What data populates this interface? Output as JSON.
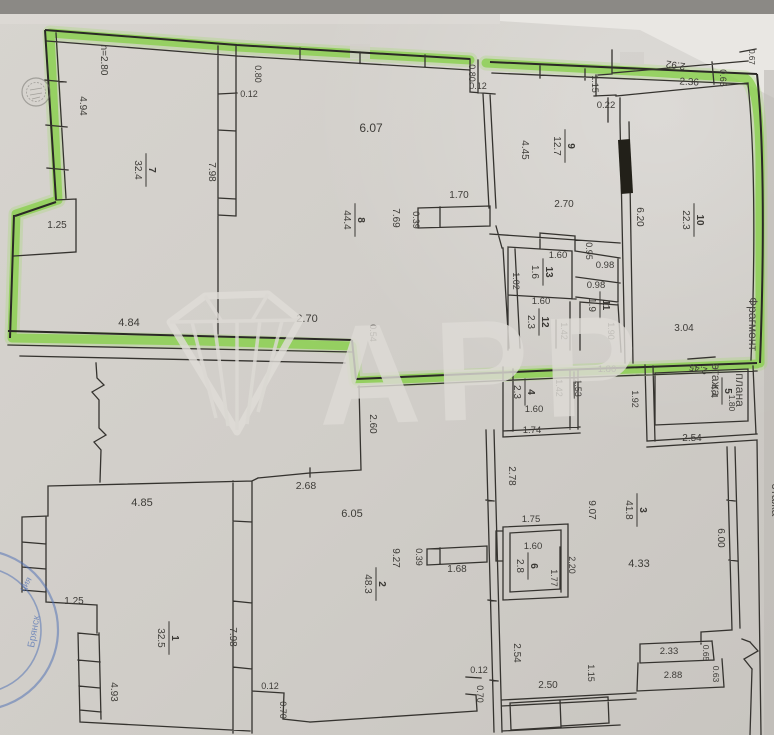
{
  "photo": {
    "description_visible_only": "scanned floor plan page with green highlighter outline",
    "colors": {
      "paper": "#d2cfca",
      "ink": "#35332f",
      "highlighter_green": "#7fce3c",
      "stamp_blue": "#4a6cb3",
      "watermark_gray": "#dedbd6",
      "photo_edge_dark": "#8b8985"
    }
  },
  "watermark": {
    "text": "АРР"
  },
  "stamps": {
    "blue": {
      "line1": "ция",
      "line2": "Брянск"
    }
  },
  "plan": {
    "captions": [
      {
        "t": "Фрагмент",
        "x": 749,
        "y": 324,
        "r": 90,
        "s": 12
      },
      {
        "t": "плана",
        "x": 736,
        "y": 390,
        "r": 90,
        "s": 12
      },
      {
        "t": "этажа",
        "x": 712,
        "y": 380,
        "r": 90,
        "s": 12
      },
      {
        "t": "этажа",
        "x": 772,
        "y": 500,
        "r": 90,
        "s": 12
      }
    ],
    "rooms": [
      {
        "n": "7",
        "a": "32.4",
        "x": 146,
        "y": 170
      },
      {
        "n": "8",
        "a": "44.4",
        "x": 355,
        "y": 220
      },
      {
        "n": "9",
        "a": "12.7",
        "x": 565,
        "y": 146
      },
      {
        "n": "10",
        "a": "22.3",
        "x": 694,
        "y": 220
      },
      {
        "n": "13",
        "a": "1.6",
        "x": 543,
        "y": 272
      },
      {
        "n": "12",
        "a": "2.3",
        "x": 539,
        "y": 322
      },
      {
        "n": "11",
        "a": "1.9",
        "x": 600,
        "y": 305
      },
      {
        "n": "4",
        "a": "2.3",
        "x": 525,
        "y": 392
      },
      {
        "n": "5",
        "a": "4.4",
        "x": 722,
        "y": 391
      },
      {
        "n": "1",
        "a": "32.5",
        "x": 169,
        "y": 638
      },
      {
        "n": "2",
        "a": "48.3",
        "x": 376,
        "y": 584
      },
      {
        "n": "3",
        "a": "41.8",
        "x": 637,
        "y": 510
      },
      {
        "n": "6",
        "a": "2.8",
        "x": 528,
        "y": 566
      }
    ],
    "dimensions": [
      {
        "t": "h=2.80",
        "x": 101,
        "y": 60,
        "r": 90,
        "s": 10
      },
      {
        "t": "4.94",
        "x": 80,
        "y": 106,
        "r": 90,
        "s": 10
      },
      {
        "t": "1.25",
        "x": 57,
        "y": 228,
        "r": 0,
        "s": 10
      },
      {
        "t": "7.98",
        "x": 209,
        "y": 172,
        "r": 90,
        "s": 10
      },
      {
        "t": "0.80",
        "x": 255,
        "y": 74,
        "r": 90,
        "s": 9
      },
      {
        "t": "0.12",
        "x": 249,
        "y": 97,
        "r": 0,
        "s": 9
      },
      {
        "t": "6.07",
        "x": 371,
        "y": 132,
        "r": 0,
        "s": 12
      },
      {
        "t": "7.69",
        "x": 393,
        "y": 218,
        "r": 90,
        "s": 10
      },
      {
        "t": "0.39",
        "x": 413,
        "y": 220,
        "r": 90,
        "s": 9
      },
      {
        "t": "1.70",
        "x": 459,
        "y": 198,
        "r": 0,
        "s": 10
      },
      {
        "t": "0.80",
        "x": 469,
        "y": 73,
        "r": 90,
        "s": 9
      },
      {
        "t": "0.12",
        "x": 478,
        "y": 89,
        "r": 0,
        "s": 9
      },
      {
        "t": "1.15",
        "x": 592,
        "y": 84,
        "r": 90,
        "s": 9
      },
      {
        "t": "0.22",
        "x": 606,
        "y": 108,
        "r": 0,
        "s": 9.5
      },
      {
        "t": "2.92",
        "x": 676,
        "y": 62,
        "r": 188,
        "s": 10
      },
      {
        "t": "2.36",
        "x": 689,
        "y": 85,
        "r": 4,
        "s": 10
      },
      {
        "t": "0.65",
        "x": 720,
        "y": 78,
        "r": 90,
        "s": 9
      },
      {
        "t": "0.67",
        "x": 749,
        "y": 57,
        "r": 90,
        "s": 8
      },
      {
        "t": "4.45",
        "x": 522,
        "y": 150,
        "r": 90,
        "s": 10
      },
      {
        "t": "2.70",
        "x": 564,
        "y": 207,
        "r": 0,
        "s": 10
      },
      {
        "t": "6.20",
        "x": 637,
        "y": 217,
        "r": 90,
        "s": 10
      },
      {
        "t": "3.04",
        "x": 684,
        "y": 331,
        "r": 0,
        "s": 10
      },
      {
        "t": "0.95",
        "x": 586,
        "y": 251,
        "r": 90,
        "s": 9
      },
      {
        "t": "0.98",
        "x": 605,
        "y": 268,
        "r": 0,
        "s": 9.5
      },
      {
        "t": "0.98",
        "x": 596,
        "y": 288,
        "r": 0,
        "s": 9.5
      },
      {
        "t": "1.60",
        "x": 558,
        "y": 258,
        "r": 0,
        "s": 9.5
      },
      {
        "t": "1.02",
        "x": 513,
        "y": 281,
        "r": 90,
        "s": 9
      },
      {
        "t": "1.60",
        "x": 541,
        "y": 304,
        "r": 0,
        "s": 9.5
      },
      {
        "t": "1.42",
        "x": 561,
        "y": 331,
        "r": 90,
        "s": 9
      },
      {
        "t": "1.90",
        "x": 608,
        "y": 331,
        "r": 90,
        "s": 9
      },
      {
        "t": "4.84",
        "x": 129,
        "y": 326,
        "r": 0,
        "s": 11
      },
      {
        "t": "2.70",
        "x": 307,
        "y": 322,
        "r": 0,
        "s": 11
      },
      {
        "t": "0.54",
        "x": 370,
        "y": 333,
        "r": 90,
        "s": 9
      },
      {
        "t": "2.60",
        "x": 370,
        "y": 424,
        "r": 90,
        "s": 10
      },
      {
        "t": "1.80",
        "x": 607,
        "y": 372,
        "r": 0,
        "s": 9.5
      },
      {
        "t": "1.53",
        "x": 575,
        "y": 388,
        "r": 90,
        "s": 9
      },
      {
        "t": "1.42",
        "x": 556,
        "y": 388,
        "r": 90,
        "s": 9
      },
      {
        "t": "1.60",
        "x": 534,
        "y": 412,
        "r": 0,
        "s": 9.5
      },
      {
        "t": "1.74",
        "x": 532,
        "y": 433,
        "r": 0,
        "s": 9.5
      },
      {
        "t": "1.92",
        "x": 632,
        "y": 399,
        "r": 90,
        "s": 9
      },
      {
        "t": "2.45",
        "x": 699,
        "y": 366,
        "r": 195,
        "s": 9.5
      },
      {
        "t": "2.54",
        "x": 692,
        "y": 441,
        "r": 0,
        "s": 10
      },
      {
        "t": "1.80",
        "x": 729,
        "y": 403,
        "r": 90,
        "s": 8.5
      },
      {
        "t": "2.78",
        "x": 509,
        "y": 476,
        "r": 90,
        "s": 10
      },
      {
        "t": "4.85",
        "x": 142,
        "y": 506,
        "r": 0,
        "s": 11
      },
      {
        "t": "1.25",
        "x": 74,
        "y": 604,
        "r": 0,
        "s": 10
      },
      {
        "t": "4.93",
        "x": 111,
        "y": 692,
        "r": 90,
        "s": 10
      },
      {
        "t": "7.98",
        "x": 230,
        "y": 637,
        "r": 90,
        "s": 10
      },
      {
        "t": "0.12",
        "x": 270,
        "y": 689,
        "r": 0,
        "s": 9
      },
      {
        "t": "0.70",
        "x": 280,
        "y": 710,
        "r": 90,
        "s": 9
      },
      {
        "t": "2.68",
        "x": 306,
        "y": 489,
        "r": 0,
        "s": 10.5
      },
      {
        "t": "6.05",
        "x": 352,
        "y": 517,
        "r": 0,
        "s": 11
      },
      {
        "t": "9.27",
        "x": 393,
        "y": 558,
        "r": 90,
        "s": 10
      },
      {
        "t": "0.39",
        "x": 416,
        "y": 557,
        "r": 90,
        "s": 9
      },
      {
        "t": "1.68",
        "x": 457,
        "y": 572,
        "r": 0,
        "s": 10
      },
      {
        "t": "0.12",
        "x": 479,
        "y": 673,
        "r": 0,
        "s": 9
      },
      {
        "t": "0.70",
        "x": 477,
        "y": 694,
        "r": 90,
        "s": 9
      },
      {
        "t": "9.07",
        "x": 589,
        "y": 510,
        "r": 90,
        "s": 10
      },
      {
        "t": "4.33",
        "x": 639,
        "y": 567,
        "r": 0,
        "s": 11
      },
      {
        "t": "6.00",
        "x": 718,
        "y": 538,
        "r": 90,
        "s": 10
      },
      {
        "t": "2.54",
        "x": 514,
        "y": 653,
        "r": 90,
        "s": 10
      },
      {
        "t": "2.50",
        "x": 548,
        "y": 688,
        "r": 0,
        "s": 10
      },
      {
        "t": "1.15",
        "x": 588,
        "y": 673,
        "r": 90,
        "s": 9
      },
      {
        "t": "2.33",
        "x": 669,
        "y": 654,
        "r": 0,
        "s": 9.5
      },
      {
        "t": "0.65",
        "x": 703,
        "y": 653,
        "r": 90,
        "s": 8.5
      },
      {
        "t": "2.88",
        "x": 673,
        "y": 678,
        "r": 0,
        "s": 9.5
      },
      {
        "t": "0.63",
        "x": 713,
        "y": 674,
        "r": 90,
        "s": 8.5
      },
      {
        "t": "1.75",
        "x": 531,
        "y": 522,
        "r": 0,
        "s": 9.5
      },
      {
        "t": "1.60",
        "x": 533,
        "y": 549,
        "r": 0,
        "s": 9.5
      },
      {
        "t": "1.77",
        "x": 551,
        "y": 578,
        "r": 90,
        "s": 9
      },
      {
        "t": "2.20",
        "x": 569,
        "y": 565,
        "r": 90,
        "s": 9
      }
    ]
  }
}
